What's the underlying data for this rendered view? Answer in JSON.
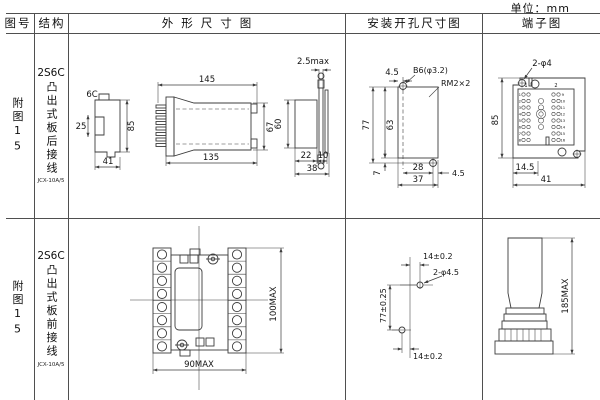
{
  "unit_label": "单位：mm",
  "colors": {
    "grid_line": "#4f4f4f",
    "drawing_line": "#3c3c3c"
  },
  "header": {
    "fig": "图号",
    "structure": "结构",
    "outline": "外形尺寸图",
    "mounting": "安装开孔尺寸图",
    "terminal": "端子图"
  },
  "r1": {
    "fig": "附图15",
    "model": "2S6C",
    "wiring": "凸出式板后接线",
    "code": "JCX-10A/5",
    "o_label": "6C",
    "o_25": "25",
    "o_85": "85",
    "o_41": "41",
    "o_145": "145",
    "o_135": "135",
    "o_67": "67",
    "o_25max": "2.5max",
    "o_60": "60",
    "o_22": "22",
    "o_10": "10",
    "o_38": "38",
    "m_45t": "4.5",
    "m_hole": "B6(φ3.2)",
    "m_stud": "RM2×2",
    "m_77": "77",
    "m_63": "63",
    "m_7": "7",
    "m_28": "28",
    "m_37": "37",
    "m_45r": "4.5",
    "t_holes": "2-φ4",
    "t_c1": "1",
    "t_c2": "2",
    "t_85": "85",
    "t_145": "14.5",
    "t_41": "41",
    "t_left": [
      "1",
      "2",
      "3",
      "4",
      "5",
      "6",
      "7",
      "8"
    ],
    "t_right": [
      "9",
      "10",
      "11",
      "12",
      "13",
      "14",
      "15",
      "16"
    ]
  },
  "r2": {
    "fig": "附图15",
    "model": "2S6C",
    "wiring": "凸出式板前接线",
    "code": "JCX-10A/5",
    "o_90": "90MAX",
    "o_100": "100MAX",
    "m_14t": "14±0.2",
    "m_holes": "2-φ4.5",
    "m_77": "77±0.25",
    "m_14b": "14±0.2",
    "t_185": "185MAX"
  }
}
